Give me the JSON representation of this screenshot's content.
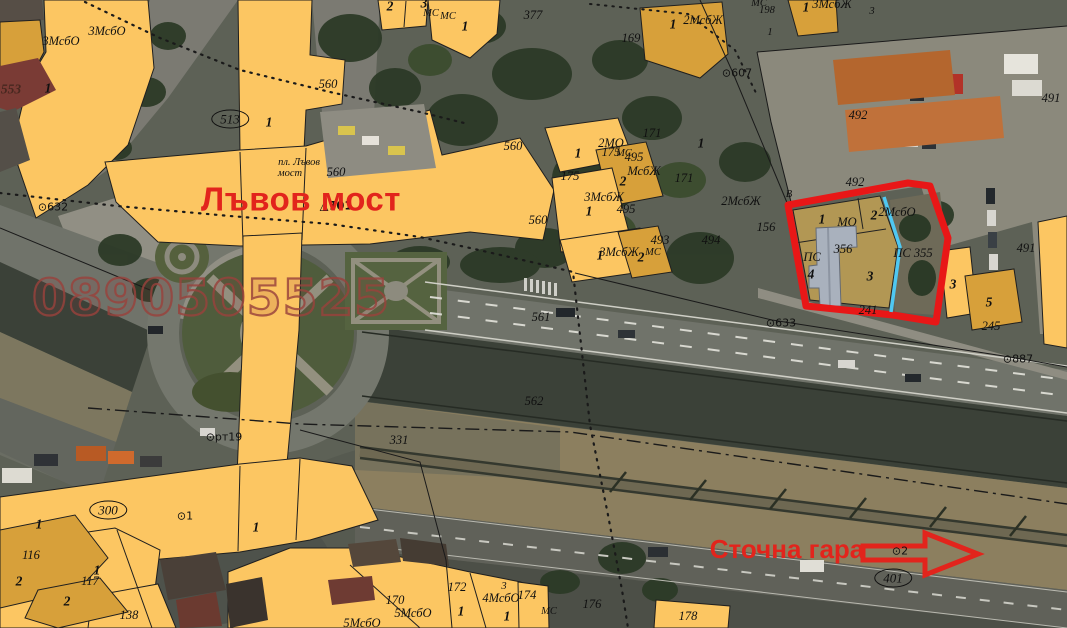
{
  "map": {
    "annotations": {
      "lion_bridge": "Лъвов мост",
      "freight_station": "Сточна гара"
    },
    "watermark": "0890505525",
    "colors": {
      "parcel_yellow": "#fcc662",
      "parcel_ochre": "#d7a03a",
      "parcel_tan": "#b29754",
      "highlight_red": "#e81717",
      "boundary_cyan": "#4fc8f2",
      "annotation_red": "#e2241c",
      "watermark_red": "#98423c"
    },
    "labels": [
      {
        "t": "3МсбО",
        "x": 107,
        "y": 31
      },
      {
        "t": "3МсбО",
        "x": 61,
        "y": 41
      },
      {
        "t": "553",
        "x": 11,
        "y": 89,
        "cls": "b maroon"
      },
      {
        "t": "1",
        "x": 48,
        "y": 88,
        "cls": "b"
      },
      {
        "t": "513",
        "x": 230,
        "y": 119,
        "cls": "circ",
        "n": "circled-number-513"
      },
      {
        "t": "1",
        "x": 269,
        "y": 122,
        "cls": "b"
      },
      {
        "t": "пл. Лъвов",
        "x": 299,
        "y": 163,
        "cls": "s"
      },
      {
        "t": "мост",
        "x": 290,
        "y": 174,
        "cls": "s"
      },
      {
        "t": "560",
        "x": 328,
        "y": 84
      },
      {
        "t": "560",
        "x": 336,
        "y": 172
      },
      {
        "t": "⊙632",
        "x": 53,
        "y": 207,
        "cls": "pt",
        "n": "point-632"
      },
      {
        "t": "△701",
        "x": 336,
        "y": 206,
        "cls": "pt b",
        "n": "point-701"
      },
      {
        "t": "2",
        "x": 390,
        "y": 6,
        "cls": "b"
      },
      {
        "t": "3",
        "x": 424,
        "y": 3,
        "cls": "b"
      },
      {
        "t": "МС",
        "x": 431,
        "y": 14,
        "cls": "s"
      },
      {
        "t": "МС",
        "x": 448,
        "y": 17,
        "cls": "s"
      },
      {
        "t": "1",
        "x": 465,
        "y": 26,
        "cls": "b"
      },
      {
        "t": "377",
        "x": 533,
        "y": 15
      },
      {
        "t": "169",
        "x": 631,
        "y": 38
      },
      {
        "t": "1",
        "x": 673,
        "y": 24,
        "cls": "b"
      },
      {
        "t": "2МсбЖ",
        "x": 703,
        "y": 20
      },
      {
        "t": "МС",
        "x": 759,
        "y": 4,
        "cls": "s"
      },
      {
        "t": "198",
        "x": 767,
        "y": 11,
        "cls": "s"
      },
      {
        "t": "1",
        "x": 806,
        "y": 7,
        "cls": "b"
      },
      {
        "t": "3МсбЖ",
        "x": 832,
        "y": 4
      },
      {
        "t": "3",
        "x": 872,
        "y": 12,
        "cls": "s"
      },
      {
        "t": "1",
        "x": 770,
        "y": 33,
        "cls": "s"
      },
      {
        "t": "⊙607",
        "x": 737,
        "y": 73,
        "cls": "pt",
        "n": "point-607"
      },
      {
        "t": "492",
        "x": 858,
        "y": 115
      },
      {
        "t": "492",
        "x": 855,
        "y": 182
      },
      {
        "t": "491",
        "x": 1051,
        "y": 98
      },
      {
        "t": "491",
        "x": 1026,
        "y": 248
      },
      {
        "t": "В",
        "x": 789,
        "y": 195,
        "cls": "s"
      },
      {
        "t": "2МсбЖ",
        "x": 741,
        "y": 201
      },
      {
        "t": "156",
        "x": 766,
        "y": 227
      },
      {
        "t": "171",
        "x": 652,
        "y": 133
      },
      {
        "t": "171",
        "x": 684,
        "y": 178
      },
      {
        "t": "1",
        "x": 701,
        "y": 143,
        "cls": "b"
      },
      {
        "t": "2МО",
        "x": 611,
        "y": 143
      },
      {
        "t": "1",
        "x": 578,
        "y": 153,
        "cls": "b"
      },
      {
        "t": "175",
        "x": 570,
        "y": 176
      },
      {
        "t": "175",
        "x": 611,
        "y": 152
      },
      {
        "t": "МС",
        "x": 624,
        "y": 154,
        "cls": "s"
      },
      {
        "t": "495",
        "x": 634,
        "y": 157
      },
      {
        "t": "МсбЖ",
        "x": 644,
        "y": 171
      },
      {
        "t": "2",
        "x": 623,
        "y": 181,
        "cls": "b"
      },
      {
        "t": "3МсбЖ",
        "x": 604,
        "y": 197
      },
      {
        "t": "1",
        "x": 589,
        "y": 211,
        "cls": "b"
      },
      {
        "t": "495",
        "x": 626,
        "y": 209
      },
      {
        "t": "560",
        "x": 513,
        "y": 146
      },
      {
        "t": "560",
        "x": 538,
        "y": 220
      },
      {
        "t": "1",
        "x": 600,
        "y": 255,
        "cls": "b"
      },
      {
        "t": "3МсбЖ",
        "x": 619,
        "y": 252
      },
      {
        "t": "2",
        "x": 641,
        "y": 257,
        "cls": "b"
      },
      {
        "t": "МС",
        "x": 653,
        "y": 253,
        "cls": "s"
      },
      {
        "t": "493",
        "x": 660,
        "y": 240
      },
      {
        "t": "494",
        "x": 711,
        "y": 240
      },
      {
        "t": "1",
        "x": 822,
        "y": 219,
        "cls": "b"
      },
      {
        "t": "МО",
        "x": 847,
        "y": 222
      },
      {
        "t": "2",
        "x": 874,
        "y": 215,
        "cls": "b"
      },
      {
        "t": "2МсбО",
        "x": 897,
        "y": 212
      },
      {
        "t": "356",
        "x": 843,
        "y": 249
      },
      {
        "t": "ПС",
        "x": 812,
        "y": 257
      },
      {
        "t": "4",
        "x": 811,
        "y": 274,
        "cls": "b"
      },
      {
        "t": "3",
        "x": 870,
        "y": 276,
        "cls": "b"
      },
      {
        "t": "ПС 355",
        "x": 913,
        "y": 253
      },
      {
        "t": "241",
        "x": 868,
        "y": 310
      },
      {
        "t": "3",
        "x": 953,
        "y": 284,
        "cls": "b"
      },
      {
        "t": "5",
        "x": 989,
        "y": 302,
        "cls": "b"
      },
      {
        "t": "245",
        "x": 991,
        "y": 326
      },
      {
        "t": "⊙633",
        "x": 781,
        "y": 323,
        "cls": "pt",
        "n": "point-633"
      },
      {
        "t": "⊙887",
        "x": 1018,
        "y": 359,
        "cls": "pt",
        "n": "point-887"
      },
      {
        "t": "561",
        "x": 541,
        "y": 317
      },
      {
        "t": "562",
        "x": 534,
        "y": 401
      },
      {
        "t": "⊙рт19",
        "x": 224,
        "y": 437,
        "cls": "pt",
        "n": "point-rt19"
      },
      {
        "t": "331",
        "x": 399,
        "y": 440
      },
      {
        "t": "⊙1",
        "x": 185,
        "y": 516,
        "cls": "pt",
        "n": "point-1"
      },
      {
        "t": "1",
        "x": 39,
        "y": 524,
        "cls": "b"
      },
      {
        "t": "1",
        "x": 256,
        "y": 527,
        "cls": "b"
      },
      {
        "t": "300",
        "x": 108,
        "y": 510,
        "cls": "circ",
        "n": "circled-number-300"
      },
      {
        "t": "116",
        "x": 31,
        "y": 555
      },
      {
        "t": "2",
        "x": 19,
        "y": 581,
        "cls": "b"
      },
      {
        "t": "1",
        "x": 97,
        "y": 570,
        "cls": "b"
      },
      {
        "t": "117",
        "x": 90,
        "y": 581
      },
      {
        "t": "2",
        "x": 67,
        "y": 601,
        "cls": "b"
      },
      {
        "t": "138",
        "x": 129,
        "y": 615
      },
      {
        "t": "172",
        "x": 457,
        "y": 587
      },
      {
        "t": "170",
        "x": 395,
        "y": 600
      },
      {
        "t": "5МсбО",
        "x": 413,
        "y": 613
      },
      {
        "t": "1",
        "x": 461,
        "y": 611,
        "cls": "b"
      },
      {
        "t": "4МсбО",
        "x": 501,
        "y": 598
      },
      {
        "t": "174",
        "x": 527,
        "y": 595
      },
      {
        "t": "1",
        "x": 507,
        "y": 616,
        "cls": "b"
      },
      {
        "t": "МС",
        "x": 549,
        "y": 612,
        "cls": "s"
      },
      {
        "t": "176",
        "x": 592,
        "y": 604
      },
      {
        "t": "3",
        "x": 504,
        "y": 587,
        "cls": "s"
      },
      {
        "t": "5МсбО",
        "x": 362,
        "y": 623
      },
      {
        "t": "178",
        "x": 688,
        "y": 616
      },
      {
        "t": "⊙2",
        "x": 900,
        "y": 551,
        "cls": "pt",
        "n": "point-2"
      },
      {
        "t": "401",
        "x": 893,
        "y": 578,
        "cls": "circ",
        "n": "circled-number-401"
      }
    ]
  }
}
